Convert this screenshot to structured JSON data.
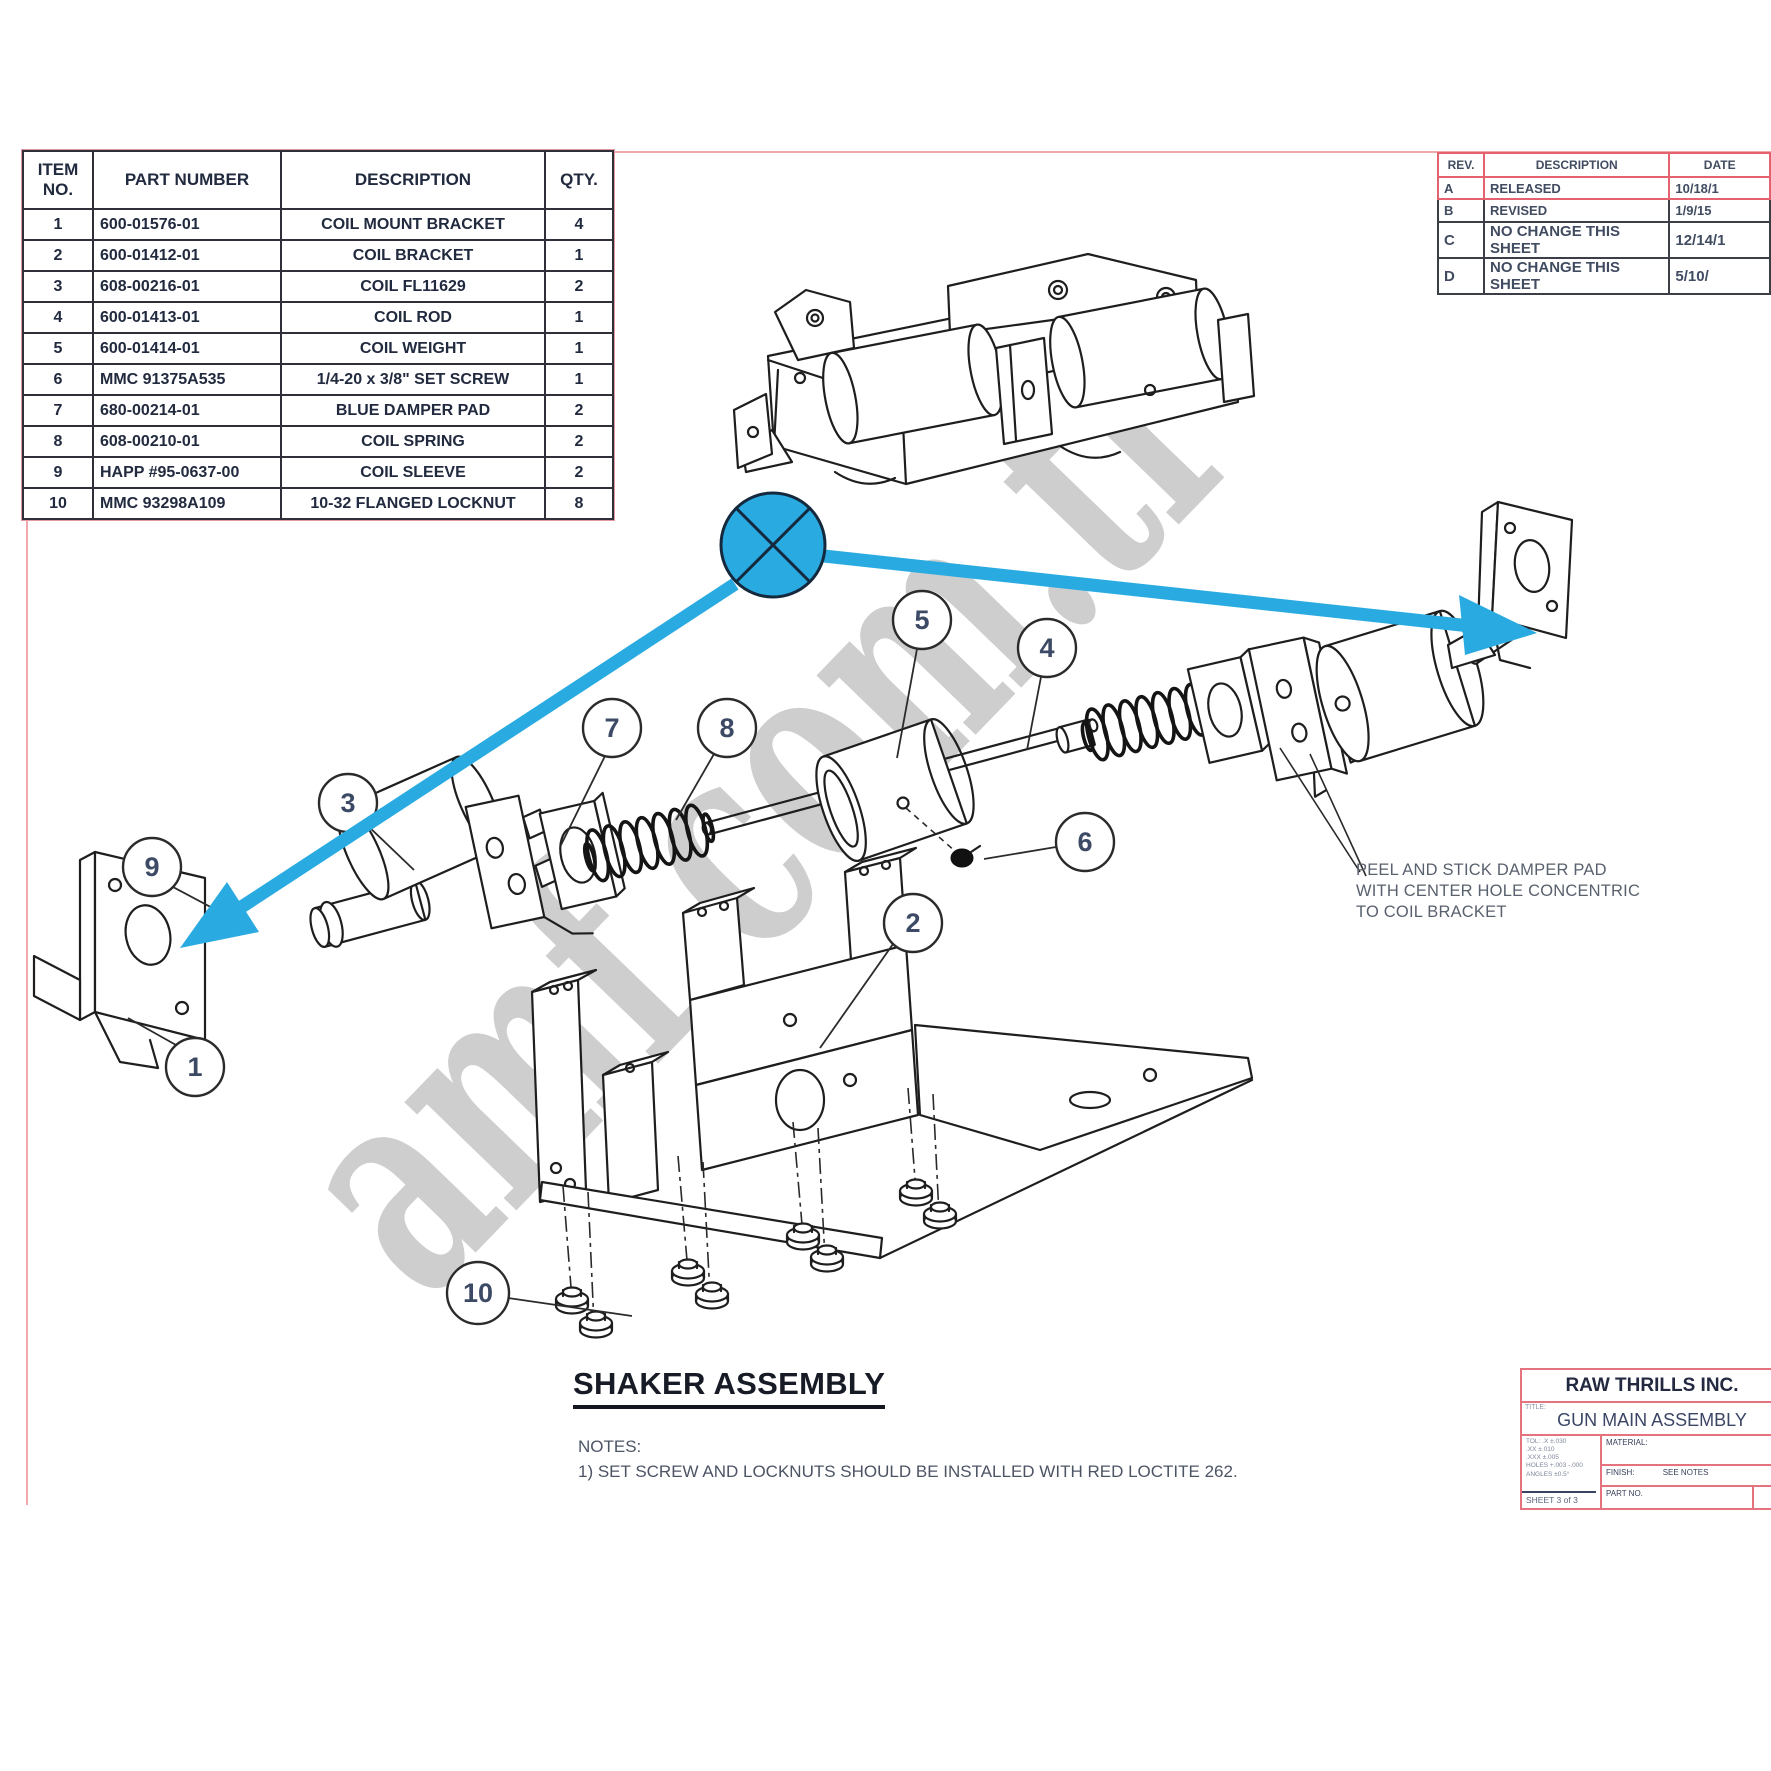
{
  "parts_table": {
    "headers": [
      "ITEM\nNO.",
      "PART NUMBER",
      "DESCRIPTION",
      "QTY."
    ],
    "rows": [
      {
        "item": "1",
        "part": "600-01576-01",
        "desc": "COIL MOUNT BRACKET",
        "qty": "4"
      },
      {
        "item": "2",
        "part": "600-01412-01",
        "desc": "COIL BRACKET",
        "qty": "1"
      },
      {
        "item": "3",
        "part": "608-00216-01",
        "desc": "COIL FL11629",
        "qty": "2"
      },
      {
        "item": "4",
        "part": "600-01413-01",
        "desc": "COIL ROD",
        "qty": "1"
      },
      {
        "item": "5",
        "part": "600-01414-01",
        "desc": "COIL WEIGHT",
        "qty": "1"
      },
      {
        "item": "6",
        "part": "MMC 91375A535",
        "desc": "1/4-20 x 3/8\" SET SCREW",
        "qty": "1"
      },
      {
        "item": "7",
        "part": "680-00214-01",
        "desc": "BLUE DAMPER PAD",
        "qty": "2"
      },
      {
        "item": "8",
        "part": "608-00210-01",
        "desc": "COIL SPRING",
        "qty": "2"
      },
      {
        "item": "9",
        "part": "HAPP  #95-0637-00",
        "desc": "COIL SLEEVE",
        "qty": "2"
      },
      {
        "item": "10",
        "part": "MMC 93298A109",
        "desc": "10-32 FLANGED LOCKNUT",
        "qty": "8"
      }
    ]
  },
  "revision_table": {
    "headers": [
      "REV.",
      "DESCRIPTION",
      "DATE"
    ],
    "rows": [
      {
        "rev": "A",
        "desc": "RELEASED",
        "date": "10/18/1",
        "style": "rev-pink row-A"
      },
      {
        "rev": "B",
        "desc": "REVISED",
        "date": "1/9/15",
        "style": "rev-dark row-B"
      },
      {
        "rev": "C",
        "desc": "NO CHANGE THIS SHEET",
        "date": "12/14/1",
        "style": "rev-dark row-C"
      },
      {
        "rev": "D",
        "desc": "NO CHANGE THIS SHEET",
        "date": "5/10/",
        "style": "rev-dark row-D"
      }
    ]
  },
  "drawing": {
    "title": "SHAKER ASSEMBLY",
    "notes_label": "NOTES:",
    "notes": [
      "1) SET SCREW AND LOCKNUTS SHOULD BE INSTALLED WITH RED LOCTITE 262."
    ],
    "annotation_lines": [
      "PEEL AND STICK DAMPER PAD",
      "WITH CENTER HOLE CONCENTRIC",
      "TO COIL BRACKET"
    ],
    "callouts": [
      {
        "n": "1",
        "x": 195,
        "y": 1067,
        "r": 29,
        "lx1": 176,
        "ly1": 1045,
        "lx2": 128,
        "ly2": 1018
      },
      {
        "n": "2",
        "x": 913,
        "y": 923,
        "r": 29,
        "lx1": 893,
        "ly1": 944,
        "lx2": 820,
        "ly2": 1048
      },
      {
        "n": "3",
        "x": 348,
        "y": 803,
        "r": 29,
        "lx1": 367,
        "ly1": 825,
        "lx2": 414,
        "ly2": 870
      },
      {
        "n": "4",
        "x": 1047,
        "y": 648,
        "r": 29,
        "lx1": 1041,
        "ly1": 677,
        "lx2": 1027,
        "ly2": 750
      },
      {
        "n": "5",
        "x": 922,
        "y": 620,
        "r": 29,
        "lx1": 917,
        "ly1": 649,
        "lx2": 897,
        "ly2": 758
      },
      {
        "n": "6",
        "x": 1085,
        "y": 842,
        "r": 29,
        "lx1": 1056,
        "ly1": 847,
        "lx2": 984,
        "ly2": 859
      },
      {
        "n": "7",
        "x": 612,
        "y": 728,
        "r": 29,
        "lx1": 605,
        "ly1": 756,
        "lx2": 561,
        "ly2": 845
      },
      {
        "n": "8",
        "x": 727,
        "y": 728,
        "r": 29,
        "lx1": 714,
        "ly1": 754,
        "lx2": 676,
        "ly2": 820
      },
      {
        "n": "9",
        "x": 152,
        "y": 867,
        "r": 29,
        "lx1": 173,
        "ly1": 887,
        "lx2": 250,
        "ly2": 928
      },
      {
        "n": "10",
        "x": 478,
        "y": 1293,
        "r": 31,
        "lx1": 508,
        "ly1": 1298,
        "lx2": 632,
        "ly2": 1316
      }
    ]
  },
  "title_block": {
    "company": "RAW THRILLS INC.",
    "title_label": "TITLE:",
    "drawing_title": "GUN MAIN ASSEMBLY",
    "material_label": "MATERIAL:",
    "finish_label": "FINISH:",
    "finish_value": "SEE NOTES",
    "part_no_label": "PART NO.",
    "sheet": "SHEET 3 of 3",
    "tolerances": [
      "TOL: .X ±.030",
      ".XX ±.010",
      ".XXX ±.005",
      "HOLES +.003 -.000",
      "ANGLES ±0.5°"
    ]
  },
  "watermark": "amf.com.tr",
  "colors": {
    "accent_blue": "#29abe2",
    "frame_pink": "#f2a9ae",
    "ink": "#1e1e1e"
  }
}
